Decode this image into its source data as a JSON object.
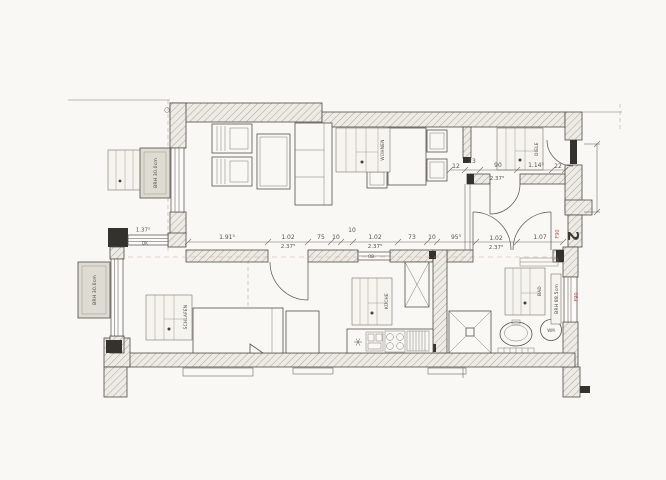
{
  "sheet": {
    "apartment_number": "2",
    "background": "#f9f8f5",
    "line_color": "#4e4b45",
    "red_color": "#c05248"
  },
  "rooms": {
    "living": "WOHNEN",
    "hall": "DIELE",
    "bedroom": "SCHLAFEN",
    "kitchen": "KÜCHE",
    "bath": "BAD"
  },
  "labels": {
    "parapet_top_left": "BRH 30.0cm",
    "parapet_bottom_left": "BRH 30.0cm",
    "parapet_right": "BRH 88.5cm",
    "fire_rating_entry": "F90",
    "fire_rating_wall": "F90",
    "washing_machine": "WM",
    "window_type": "DK",
    "kitchen_opening": "OB",
    "window_width": "1.37⁵"
  },
  "dims_main": [
    {
      "t": "1.91⁵"
    },
    {
      "t": "1.02"
    },
    {
      "t": "2.37⁵"
    },
    {
      "t": "75"
    },
    {
      "t": "10"
    },
    {
      "t": "10"
    },
    {
      "t": "1.02"
    },
    {
      "t": "2.37⁵"
    },
    {
      "t": "73"
    },
    {
      "t": "10"
    },
    {
      "t": "95⁵"
    },
    {
      "t": "1.02"
    },
    {
      "t": "2.37⁵"
    },
    {
      "t": "1.07"
    }
  ],
  "dims_hall": [
    {
      "t": "12"
    },
    {
      "t": "23"
    },
    {
      "t": "90"
    },
    {
      "t": "2.37⁵"
    },
    {
      "t": "1.14⁵"
    },
    {
      "t": "22"
    }
  ]
}
